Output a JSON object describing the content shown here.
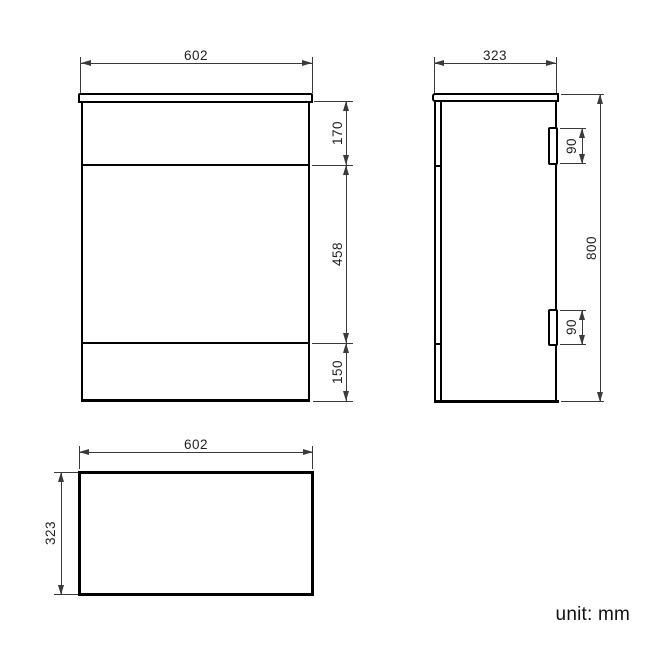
{
  "unit_note": "unit: mm",
  "dimensions": {
    "front": {
      "width": "602",
      "top_section": "170",
      "middle_section": "458",
      "bottom_section": "150"
    },
    "side": {
      "depth": "323",
      "height": "800",
      "hinge_top": "90",
      "hinge_bottom": "90"
    },
    "top": {
      "width": "602",
      "depth": "323"
    }
  },
  "colors": {
    "object_line": "#000000",
    "dimension_line": "#3a3a3a",
    "label_text": "#1f1f1f",
    "background": "#ffffff"
  }
}
